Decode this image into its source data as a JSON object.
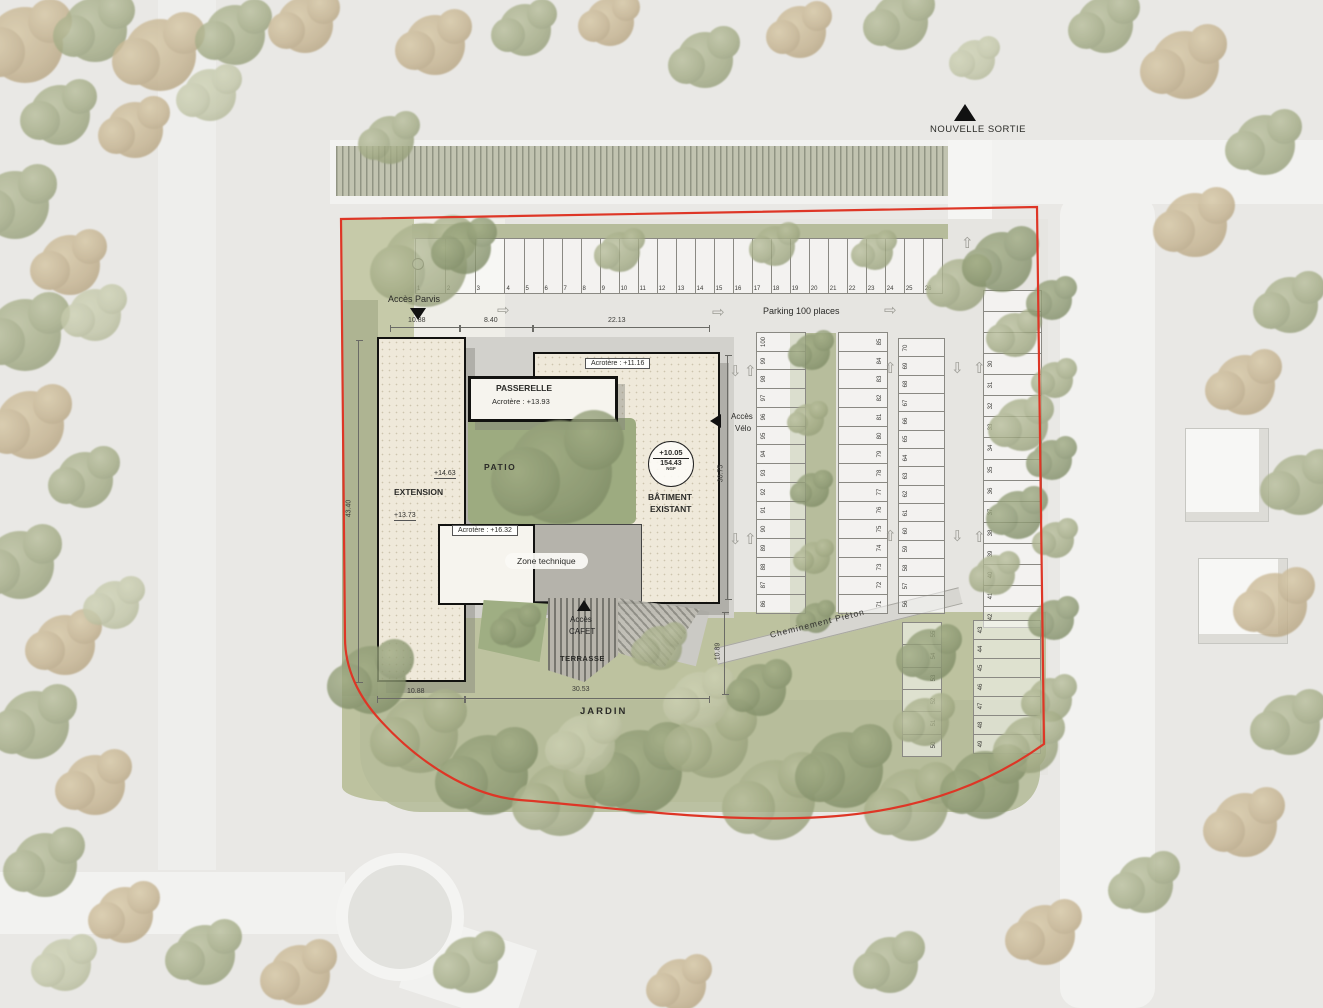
{
  "labels": {
    "nouvelle_sortie": "NOUVELLE SORTIE",
    "acces_parvis": "Accès Parvis",
    "parking": "Parking 100 places",
    "passerelle": "PASSERELLE",
    "passerelle_acrotere": "Acrotère : +13.93",
    "acrotere_existant": "Acrotère : +11.16",
    "acrotere_technique": "Acrotère : +16.32",
    "patio": "PATIO",
    "extension": "EXTENSION",
    "batiment_1": "BÂTIMENT",
    "batiment_2": "EXISTANT",
    "zone_technique": "Zone technique",
    "acces_velo_1": "Accès",
    "acces_velo_2": "Vélo",
    "acces_cafet_1": "Accès",
    "acces_cafet_2": "CAFET",
    "terrasse": "TERRASSE",
    "jardin": "JARDIN",
    "cheminement": "Cheminement Piéton",
    "level_ext_1": "+14.63",
    "level_ext_2": "+13.73",
    "ngf_top": "+10.05",
    "ngf_mid": "154.43",
    "ngf_unit": "NGF"
  },
  "dimensions": {
    "top_1": "10.88",
    "top_2": "8.40",
    "top_3": "22.13",
    "left": "43.40",
    "right": "30.75",
    "bottom_1": "10.88",
    "bottom_2": "30.53",
    "terrasse": "10.89"
  },
  "parking": {
    "row_top": [
      "1",
      "2",
      "3",
      "4",
      "5",
      "6",
      "7",
      "8",
      "9",
      "10",
      "11",
      "12",
      "13",
      "14",
      "15",
      "16",
      "17",
      "18",
      "19",
      "20",
      "21",
      "22",
      "23",
      "24",
      "25",
      "26"
    ],
    "col_a": [
      "100",
      "99",
      "98",
      "97",
      "96",
      "95",
      "94",
      "93",
      "92",
      "91",
      "90",
      "89",
      "88",
      "87",
      "86"
    ],
    "col_b": [
      "85",
      "84",
      "83",
      "82",
      "81",
      "80",
      "79",
      "78",
      "77",
      "76",
      "75",
      "74",
      "73",
      "72",
      "71"
    ],
    "col_c": [
      "70",
      "69",
      "68",
      "67",
      "66",
      "65",
      "64",
      "63",
      "62",
      "61",
      "60",
      "59",
      "58",
      "57",
      "56"
    ],
    "col_d": [
      "",
      "",
      "",
      "30",
      "31",
      "32",
      "33",
      "34",
      "35",
      "36",
      "37",
      "38",
      "39",
      "40",
      "41",
      "42"
    ],
    "col_e": [
      "55",
      "54",
      "53",
      "52",
      "51",
      "50"
    ],
    "col_f": [
      "43",
      "44",
      "45",
      "46",
      "47",
      "48",
      "49"
    ]
  },
  "arrows": [
    {
      "g": "⇨",
      "x": 497,
      "y": 303
    },
    {
      "g": "⇨",
      "x": 712,
      "y": 305
    },
    {
      "g": "⇨",
      "x": 884,
      "y": 303
    },
    {
      "g": "⇧",
      "x": 961,
      "y": 236
    },
    {
      "g": "⇩",
      "x": 729,
      "y": 364
    },
    {
      "g": "⇧",
      "x": 744,
      "y": 364
    },
    {
      "g": "⇩",
      "x": 729,
      "y": 532
    },
    {
      "g": "⇧",
      "x": 744,
      "y": 532
    },
    {
      "g": "⇧",
      "x": 884,
      "y": 361
    },
    {
      "g": "⇩",
      "x": 951,
      "y": 361
    },
    {
      "g": "⇧",
      "x": 884,
      "y": 529
    },
    {
      "g": "⇩",
      "x": 951,
      "y": 529
    },
    {
      "g": "⇧",
      "x": 973,
      "y": 361
    },
    {
      "g": "⇧",
      "x": 973,
      "y": 530
    }
  ],
  "veg": [
    {
      "x": 25,
      "y": 45,
      "r": 38,
      "c": "t3"
    },
    {
      "x": 95,
      "y": 30,
      "r": 32,
      "c": "t1"
    },
    {
      "x": 160,
      "y": 55,
      "r": 36,
      "c": "t3"
    },
    {
      "x": 235,
      "y": 35,
      "r": 30,
      "c": "t1"
    },
    {
      "x": 305,
      "y": 25,
      "r": 28,
      "c": "t3"
    },
    {
      "x": 210,
      "y": 95,
      "r": 26,
      "c": "t4"
    },
    {
      "x": 60,
      "y": 115,
      "r": 30,
      "c": "t1"
    },
    {
      "x": 135,
      "y": 130,
      "r": 28,
      "c": "t3"
    },
    {
      "x": 15,
      "y": 205,
      "r": 34,
      "c": "t1"
    },
    {
      "x": 70,
      "y": 265,
      "r": 30,
      "c": "t3"
    },
    {
      "x": 25,
      "y": 335,
      "r": 36,
      "c": "t1"
    },
    {
      "x": 95,
      "y": 315,
      "r": 26,
      "c": "t4"
    },
    {
      "x": 30,
      "y": 425,
      "r": 34,
      "c": "t3"
    },
    {
      "x": 85,
      "y": 480,
      "r": 28,
      "c": "t1"
    },
    {
      "x": 20,
      "y": 565,
      "r": 34,
      "c": "t1"
    },
    {
      "x": 65,
      "y": 645,
      "r": 30,
      "c": "t3"
    },
    {
      "x": 115,
      "y": 605,
      "r": 24,
      "c": "t4"
    },
    {
      "x": 35,
      "y": 725,
      "r": 34,
      "c": "t1"
    },
    {
      "x": 95,
      "y": 785,
      "r": 30,
      "c": "t3"
    },
    {
      "x": 45,
      "y": 865,
      "r": 32,
      "c": "t1"
    },
    {
      "x": 125,
      "y": 915,
      "r": 28,
      "c": "t3"
    },
    {
      "x": 205,
      "y": 955,
      "r": 30,
      "c": "t1"
    },
    {
      "x": 65,
      "y": 965,
      "r": 26,
      "c": "t4"
    },
    {
      "x": 300,
      "y": 975,
      "r": 30,
      "c": "t3"
    },
    {
      "x": 470,
      "y": 965,
      "r": 28,
      "c": "t1"
    },
    {
      "x": 680,
      "y": 985,
      "r": 26,
      "c": "t3"
    },
    {
      "x": 890,
      "y": 965,
      "r": 28,
      "c": "t1"
    },
    {
      "x": 1045,
      "y": 935,
      "r": 30,
      "c": "t3"
    },
    {
      "x": 1145,
      "y": 885,
      "r": 28,
      "c": "t1"
    },
    {
      "x": 1245,
      "y": 825,
      "r": 32,
      "c": "t3"
    },
    {
      "x": 1290,
      "y": 725,
      "r": 30,
      "c": "t1"
    },
    {
      "x": 1275,
      "y": 605,
      "r": 32,
      "c": "t3"
    },
    {
      "x": 1300,
      "y": 485,
      "r": 30,
      "c": "t1"
    },
    {
      "x": 1245,
      "y": 385,
      "r": 30,
      "c": "t3"
    },
    {
      "x": 1290,
      "y": 305,
      "r": 28,
      "c": "t1"
    },
    {
      "x": 1195,
      "y": 225,
      "r": 32,
      "c": "t3"
    },
    {
      "x": 1265,
      "y": 145,
      "r": 30,
      "c": "t1"
    },
    {
      "x": 1185,
      "y": 65,
      "r": 34,
      "c": "t3"
    },
    {
      "x": 1105,
      "y": 25,
      "r": 28,
      "c": "t1"
    },
    {
      "x": 435,
      "y": 45,
      "r": 30,
      "c": "t3"
    },
    {
      "x": 525,
      "y": 30,
      "r": 26,
      "c": "t1"
    },
    {
      "x": 610,
      "y": 22,
      "r": 24,
      "c": "t3"
    },
    {
      "x": 705,
      "y": 60,
      "r": 28,
      "c": "t1"
    },
    {
      "x": 800,
      "y": 32,
      "r": 26,
      "c": "t3"
    },
    {
      "x": 900,
      "y": 22,
      "r": 28,
      "c": "t1"
    },
    {
      "x": 975,
      "y": 60,
      "r": 20,
      "c": "t4"
    },
    {
      "x": 390,
      "y": 140,
      "r": 24,
      "c": "t1"
    },
    {
      "x": 425,
      "y": 265,
      "r": 42,
      "c": "t1"
    },
    {
      "x": 465,
      "y": 248,
      "r": 26,
      "c": "t2"
    },
    {
      "x": 620,
      "y": 252,
      "r": 20,
      "c": "t1"
    },
    {
      "x": 775,
      "y": 246,
      "r": 20,
      "c": "t1"
    },
    {
      "x": 875,
      "y": 252,
      "r": 18,
      "c": "t1"
    },
    {
      "x": 960,
      "y": 285,
      "r": 26,
      "c": "t1"
    },
    {
      "x": 1002,
      "y": 262,
      "r": 30,
      "c": "t2"
    },
    {
      "x": 1015,
      "y": 335,
      "r": 22,
      "c": "t1"
    },
    {
      "x": 1022,
      "y": 425,
      "r": 26,
      "c": "t1"
    },
    {
      "x": 1018,
      "y": 515,
      "r": 24,
      "c": "t2"
    },
    {
      "x": 995,
      "y": 575,
      "r": 20,
      "c": "t1"
    },
    {
      "x": 812,
      "y": 352,
      "r": 18,
      "c": "t2"
    },
    {
      "x": 808,
      "y": 420,
      "r": 16,
      "c": "t1"
    },
    {
      "x": 812,
      "y": 490,
      "r": 17,
      "c": "t2"
    },
    {
      "x": 814,
      "y": 558,
      "r": 16,
      "c": "t1"
    },
    {
      "x": 816,
      "y": 618,
      "r": 15,
      "c": "t2"
    },
    {
      "x": 560,
      "y": 472,
      "r": 52,
      "c": "t2"
    },
    {
      "x": 516,
      "y": 628,
      "r": 20,
      "c": "t2"
    },
    {
      "x": 660,
      "y": 648,
      "r": 22,
      "c": "t1"
    },
    {
      "x": 1052,
      "y": 300,
      "r": 20,
      "c": "t2"
    },
    {
      "x": 1055,
      "y": 380,
      "r": 18,
      "c": "t1"
    },
    {
      "x": 1052,
      "y": 460,
      "r": 20,
      "c": "t2"
    },
    {
      "x": 1056,
      "y": 540,
      "r": 18,
      "c": "t1"
    },
    {
      "x": 1054,
      "y": 620,
      "r": 20,
      "c": "t2"
    },
    {
      "x": 1050,
      "y": 700,
      "r": 22,
      "c": "t1"
    },
    {
      "x": 372,
      "y": 680,
      "r": 34,
      "c": "t2"
    },
    {
      "x": 420,
      "y": 735,
      "r": 38,
      "c": "t1"
    },
    {
      "x": 488,
      "y": 775,
      "r": 40,
      "c": "t2"
    },
    {
      "x": 560,
      "y": 800,
      "r": 36,
      "c": "t1"
    },
    {
      "x": 640,
      "y": 772,
      "r": 42,
      "c": "t2"
    },
    {
      "x": 712,
      "y": 742,
      "r": 36,
      "c": "t1"
    },
    {
      "x": 700,
      "y": 700,
      "r": 28,
      "c": "t4"
    },
    {
      "x": 775,
      "y": 800,
      "r": 40,
      "c": "t1"
    },
    {
      "x": 845,
      "y": 770,
      "r": 38,
      "c": "t2"
    },
    {
      "x": 912,
      "y": 805,
      "r": 36,
      "c": "t1"
    },
    {
      "x": 985,
      "y": 785,
      "r": 34,
      "c": "t2"
    },
    {
      "x": 1030,
      "y": 745,
      "r": 28,
      "c": "t1"
    },
    {
      "x": 930,
      "y": 655,
      "r": 26,
      "c": "t2"
    },
    {
      "x": 925,
      "y": 722,
      "r": 24,
      "c": "t1"
    },
    {
      "x": 585,
      "y": 745,
      "r": 30,
      "c": "t4"
    },
    {
      "x": 760,
      "y": 690,
      "r": 26,
      "c": "t2"
    }
  ],
  "colors": {
    "boundary": "#de3626",
    "building_fill": "#efe9da",
    "technical_gray": "#b5b3ab",
    "patio_green": "#9dab80"
  }
}
